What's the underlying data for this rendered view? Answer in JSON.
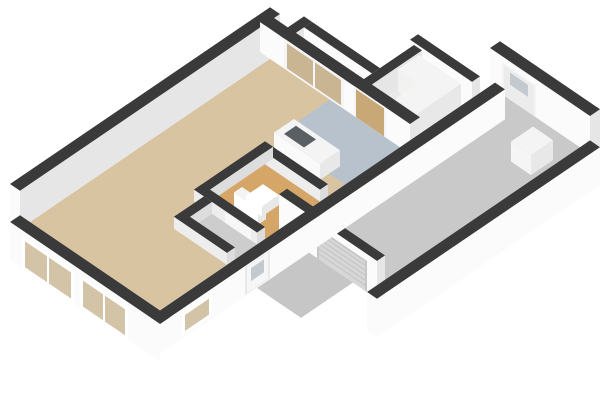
{
  "scene": {
    "type": "isometric-3d-floor-plan",
    "background": "#ffffff",
    "width": 600,
    "height": 400
  },
  "palette": {
    "wall_top": "#3a3a3a",
    "wall_face": "#fbfbfb",
    "wall_face_shaded": "#e6e6e6",
    "inner_wall_face": "#ededed",
    "inner_wall_shaded": "#dddddd",
    "fixture_face": "#fafafa",
    "fixture_shaded": "#e8e8e8",
    "fixture_top": "#f4f4f4"
  },
  "rooms": [
    {
      "id": "living",
      "name": "Living room",
      "floor_color": "#d9c4a2"
    },
    {
      "id": "kitchen",
      "name": "Kitchen",
      "floor_color": "#b7c2cc"
    },
    {
      "id": "hallway",
      "name": "Hallway",
      "floor_color": "#cdcdcd"
    },
    {
      "id": "toilet",
      "name": "Toilet",
      "floor_color": "#d6a668"
    },
    {
      "id": "strip",
      "name": "Rear hall",
      "floor_color": "#eaeae8"
    },
    {
      "id": "utility",
      "name": "Utility room",
      "floor_color": "#eaeae8"
    },
    {
      "id": "garage",
      "name": "Garage",
      "floor_color": "#c9c9c9"
    },
    {
      "id": "porch",
      "name": "Entrance porch",
      "floor_color": "#c6c6c6"
    }
  ],
  "fixtures": [
    {
      "id": "toilet-unit",
      "color": "#ffffff"
    },
    {
      "id": "kitchen-sink-counter",
      "color": "#f4f4f4",
      "basin_color": "#5a5f63"
    },
    {
      "id": "utility-counter-1",
      "color": "#f2f2f0"
    },
    {
      "id": "utility-counter-2",
      "color": "#f2f2f0"
    },
    {
      "id": "boiler-unit",
      "color": "#f5f5f5"
    }
  ],
  "openings": [
    {
      "id": "front-window-1",
      "frame_color": "#ffffff",
      "glass_color": "#d3c4a7"
    },
    {
      "id": "front-window-2",
      "frame_color": "#ffffff",
      "glass_color": "#d3c4a7"
    },
    {
      "id": "side-window",
      "frame_color": "#ffffff",
      "glass_color": "#d3c4a7"
    },
    {
      "id": "front-door",
      "color": "#f6f6f6",
      "pane_color": "#c2c9cf"
    },
    {
      "id": "garage-door",
      "color": "#d7d7d7",
      "rib_color": "#bfbfbf",
      "border_color": "#c6c6c6"
    },
    {
      "id": "garage-back-door",
      "color": "#ececec",
      "frame_color": "#f4f4f4",
      "pane_color": "#c2c9cf"
    },
    {
      "id": "glass-double-doors",
      "frame_color": "#f5f5f5",
      "glass_color": "#c9b592"
    },
    {
      "id": "utility-door",
      "color": "#c8a876",
      "frame_color": "#f4f4f4"
    },
    {
      "id": "toilet-door",
      "color": "#f7f7f7"
    }
  ]
}
